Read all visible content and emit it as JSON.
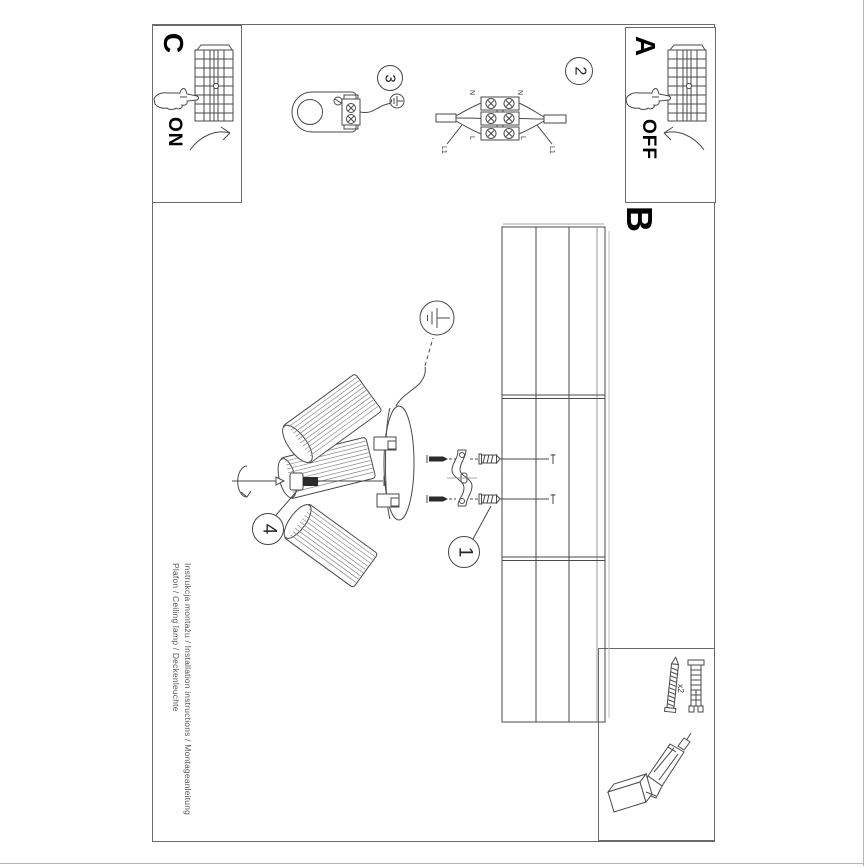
{
  "document": {
    "type": "installation-instructions",
    "footer": {
      "line1": "Instrukcja montażu / Installation instructions / Montageanleitung",
      "line2": "Plafon / Ceiling lamp / Deckenleuchte"
    }
  },
  "power_boxes": {
    "c": {
      "letter": "C",
      "state": "ON"
    },
    "a": {
      "letter": "A",
      "state": "OFF"
    }
  },
  "section_b": {
    "letter": "B"
  },
  "steps": {
    "one": "1",
    "two": "2",
    "three": "3",
    "four": "4"
  },
  "wiring_labels": {
    "n_left": "N",
    "n_right": "N",
    "l_left": "L",
    "l_right": "L",
    "l1_left": "L1",
    "l1_right": "L1"
  },
  "parts_box": {
    "step": "1",
    "quantity": "x2"
  },
  "icons": [
    "breaker-panel-icon",
    "pointing-hand-icon",
    "rotate-arrow-icon",
    "ground-symbol-icon",
    "lamp-holder-icon",
    "terminal-block-diagram",
    "ceiling-panel",
    "lamp-canopy",
    "lamp-shade",
    "power-cord",
    "set-screw",
    "mounting-bracket",
    "mounting-screw",
    "wall-plug",
    "drill-icon"
  ],
  "colors": {
    "line": "#4a4a4a",
    "frame": "#6a6a6a",
    "panel_gray": "#999999",
    "text": "#111111",
    "muted": "#555555"
  }
}
